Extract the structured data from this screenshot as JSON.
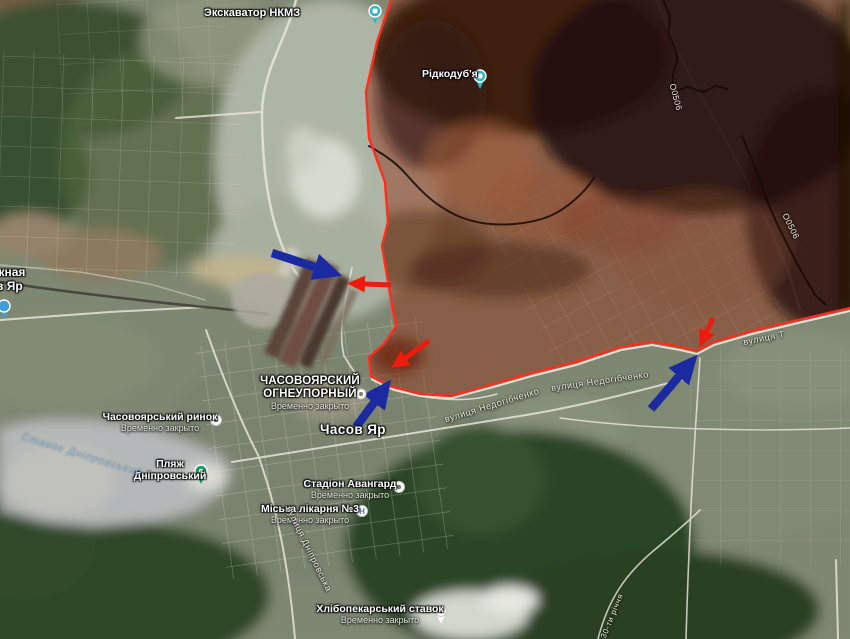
{
  "map_title": "Часів Яр — супутникова карта з лінією фронту",
  "colors": {
    "arrow-blue": "#1b2a9e",
    "arrow-red": "#ee1c0e",
    "frontline": "#ff2d1e",
    "occupied-tint": "#93341c",
    "water-label": "#8db3d2"
  },
  "common": {
    "closed": "Временно закрыто"
  },
  "pois": {
    "excavator": "Экскаватор НКМЗ",
    "ridkodubya": "Рідкодуб'я",
    "station_cut_line1": "жная",
    "station_cut_line2": "в Яр",
    "plant_line1": "ЧАСОВОЯРСКИЙ",
    "plant_line2": "ОГНЕУПОРНЫЙ",
    "market": "Часовоярський ринок",
    "town": "Часов Яр",
    "beach_line1": "Пляж",
    "beach_line2": "Дніпровський",
    "stadium": "Стадіон Авангард",
    "hospital": "Міська лікарня №3",
    "bakery_pond": "Хлібопекарський ставок"
  },
  "water": {
    "lake": "Ставок Дніпровський"
  },
  "streets": {
    "dniprovska": "вулиця Дніпровська",
    "nedohibchenko": "вулиця Недогібченко",
    "right_partial": "вулиця Т",
    "route": "О0506",
    "thirty": "30-ти річчя"
  },
  "icons": {
    "hospital_glyph": "H"
  }
}
